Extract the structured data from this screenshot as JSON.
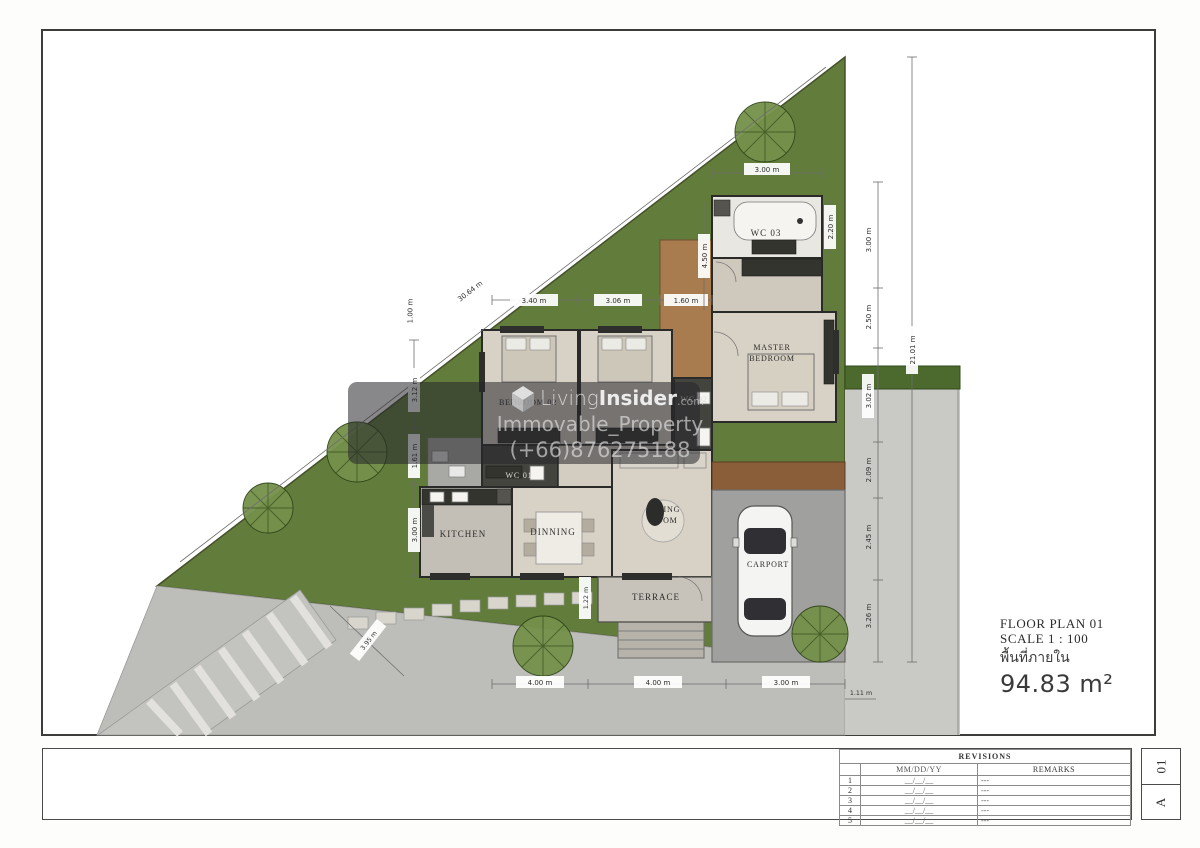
{
  "sheet": {
    "title": "FLOOR PLAN 01",
    "scale": "SCALE 1 : 100",
    "area_label_th": "พื้นที่ภายใน",
    "area_value": "94.83 m²",
    "code_letter": "A",
    "code_number": "01"
  },
  "revisions": {
    "title": "REVISIONS",
    "date_header": "MM/DD/YY",
    "remarks_header": "REMARKS",
    "rows": [
      {
        "no": "1",
        "date": "__/__/__",
        "remark": "---"
      },
      {
        "no": "2",
        "date": "__/__/__",
        "remark": "---"
      },
      {
        "no": "3",
        "date": "__/__/__",
        "remark": "---"
      },
      {
        "no": "4",
        "date": "__/__/__",
        "remark": "---"
      },
      {
        "no": "5",
        "date": "__/__/__",
        "remark": "---"
      }
    ]
  },
  "watermark": {
    "brand_light": "Living",
    "brand_bold": "Insider",
    "brand_suffix": ".com",
    "account": "Immovable_Property",
    "phone": "(+66)876275188"
  },
  "rooms": {
    "wc03": "WC 03",
    "master_line1": "MASTER",
    "master_line2": "BEDROOM",
    "wc02": "WC 02",
    "bedroom02": "BEDROOM 02",
    "wc01": "WC 01",
    "kitchen": "KITCHEN",
    "dinning": "DINNING",
    "living_line1": "LIVING",
    "living_line2": "ROOM",
    "terrace": "TERRACE",
    "carport": "CARPORT"
  },
  "dims": {
    "top_wc03": "3.00 m",
    "top1": "3.40 m",
    "top2": "3.06 m",
    "top3": "1.60 m",
    "hypotenuse": "30.64 m",
    "left_offset": "1.00 m",
    "left1": "3.12 m",
    "left2": "1.61 m",
    "left3": "3.00 m",
    "wc03_side": "4.50 m",
    "wc03_width": "2.20 m",
    "right1": "3.00 m",
    "right2": "2.50 m",
    "right3": "3.02 m",
    "right4": "2.09 m",
    "right5": "2.45 m",
    "right6": "3.26 m",
    "right_total": "21.01 m",
    "bottom1": "4.00 m",
    "bottom2": "4.00 m",
    "bottom3": "3.00 m",
    "bottom4": "1.11 m",
    "terrace_step": "1.22 m",
    "road_left": "3.95 m"
  },
  "colors": {
    "lawn": "#617c3b",
    "hedge": "#4c6a2d",
    "road": "#c2c2bf",
    "floor": "#d8d1c5",
    "wood": "#a97c50",
    "marble": "#44443f",
    "wall": "#2a2a28",
    "watermark_bg": "rgba(38,38,44,0.55)"
  }
}
